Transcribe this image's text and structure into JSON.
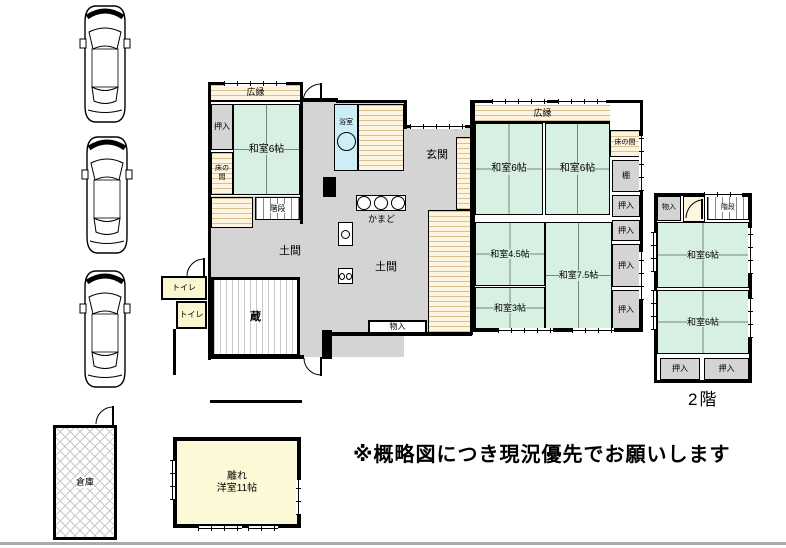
{
  "labels": {
    "hiroen": "広縁",
    "oshiire": "押入",
    "washitsu6": "和室6帖",
    "washitsu45": "和室4.5帖",
    "washitsu75": "和室7.5帖",
    "washitsu3": "和室3帖",
    "tokonoma": "床の間",
    "kaidan": "階段",
    "yokushitsu": "浴室",
    "genkan": "玄関",
    "kamado": "かまど",
    "doma": "土間",
    "kura": "蔵",
    "toire": "トイレ",
    "monoire": "物入",
    "tana": "棚",
    "nikai": "2階",
    "souko": "倉庫",
    "hanare": "離れ",
    "hanare_room": "洋室11帖"
  },
  "note": "※概略図につき現況優先でお願いします",
  "colors": {
    "tatami": "#d7f0e2",
    "doma": "#d4d4d4",
    "bath": "#cdeef4",
    "toilet": "#faf6d0",
    "hanare": "#fbf9d6",
    "closet": "#d4d4d4",
    "wall": "#000000"
  }
}
